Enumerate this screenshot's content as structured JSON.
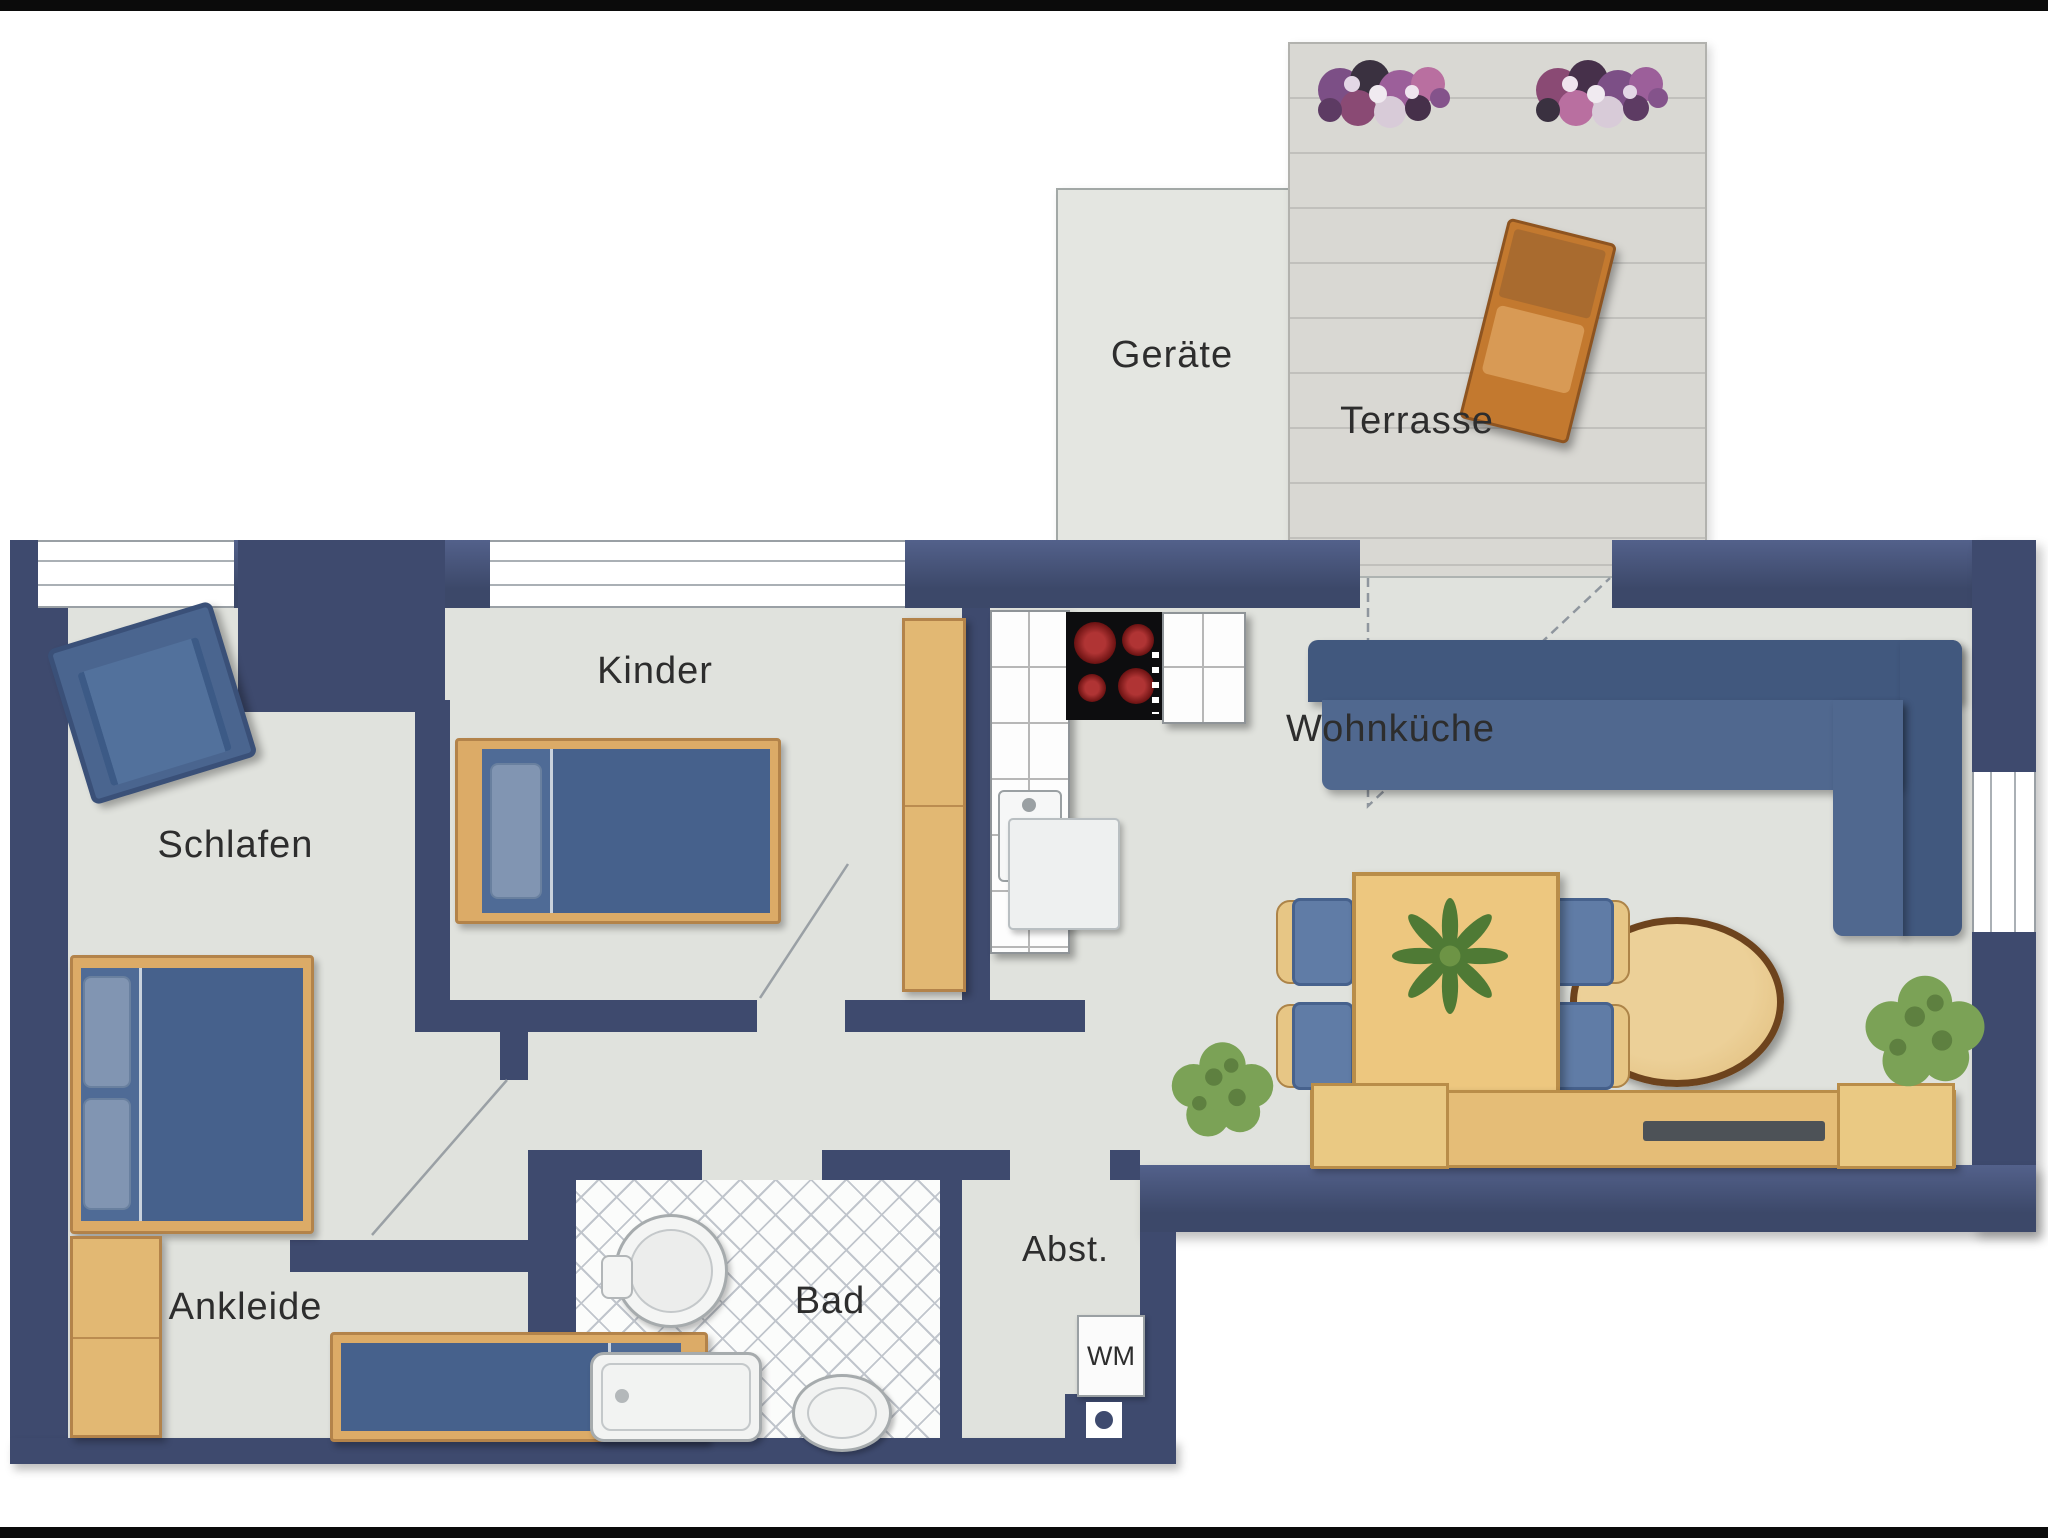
{
  "plan": {
    "labels": {
      "geraete": "Geräte",
      "terrasse": "Terrasse",
      "schlafen": "Schlafen",
      "kinder": "Kinder",
      "wohnkueche": "Wohnküche",
      "ankleide": "Ankleide",
      "bad": "Bad",
      "abst": "Abst.",
      "wm": "WM"
    },
    "colors": {
      "wall": "#3e4a6e",
      "floor": "#e0e2dd",
      "deck": "#d9d8d3",
      "wood_furniture": "#dcab67",
      "blue_furniture": "#4f6b96",
      "tile_line": "#c0c5cc",
      "stove": "#0d0d0f",
      "burner_red": "#b03434",
      "plant_green": "#7ba256",
      "lounge_orange": "#c3792f"
    },
    "furniture_icons": [
      "armchair",
      "double-bed",
      "single-bed-kinder",
      "single-bed-ankleide",
      "wardrobe-kinder",
      "wardrobe-ankleide",
      "kitchen-counter",
      "stove",
      "kitchen-sink",
      "corner-sofa",
      "oval-coffee-table",
      "dining-table",
      "dining-chairs",
      "table-plant",
      "sideboard",
      "tv",
      "potted-plants",
      "washbasin",
      "shower-tray",
      "toilet",
      "washing-machine",
      "floor-drain",
      "lounge-chair",
      "flower-planters",
      "door-swings",
      "windows"
    ]
  }
}
